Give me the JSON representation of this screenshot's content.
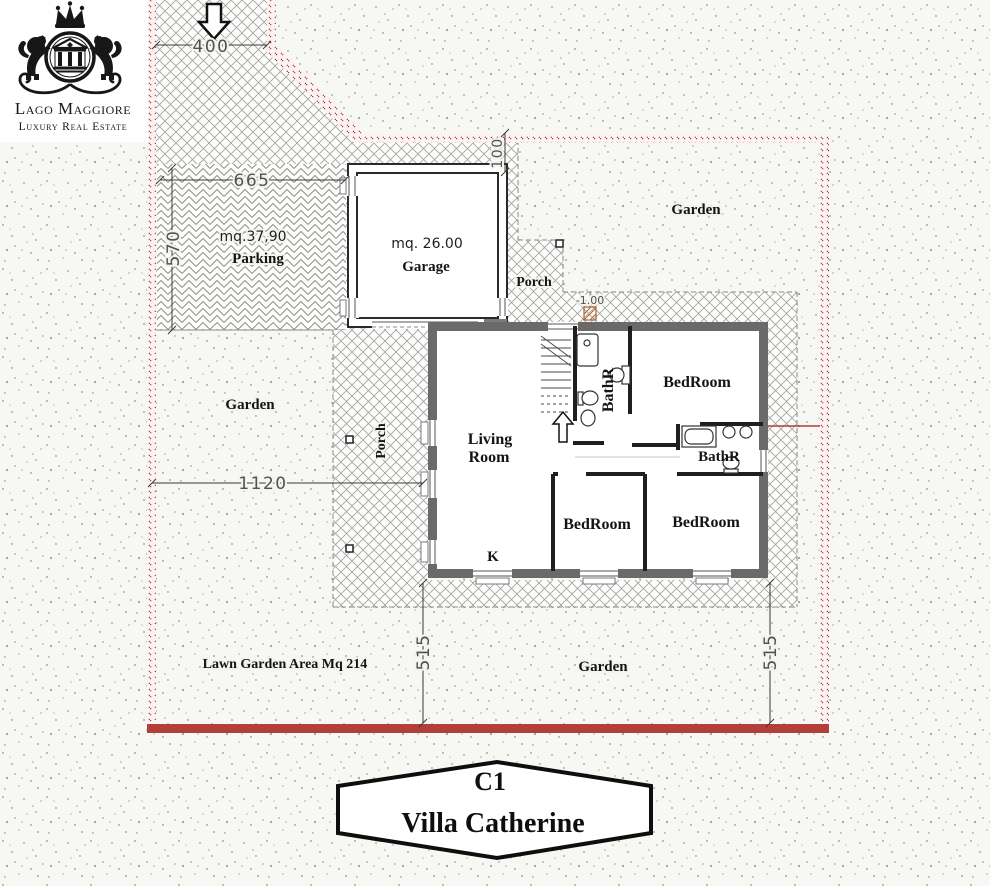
{
  "meta": {
    "title": "Villa Catherine floor plan"
  },
  "colors": {
    "boundary_red": "#b23f3a",
    "wall_gray": "#6a6a6a",
    "hatch_gray": "#9a9a9a",
    "paper": "#f6f6f2",
    "step_marker_orange": "#b06030"
  },
  "logo": {
    "line1": "Lago Maggiore",
    "line2": "Luxury Real Estate"
  },
  "icons": {
    "entrance": "arrow-down-icon",
    "stairs": "arrow-up-icon",
    "crown": "crown-icon",
    "left_lion": "lion-icon",
    "right_lion": "lion-icon",
    "emblem": "temple-icon"
  },
  "dimensions": {
    "entrance_width": "400",
    "parking_width": "665",
    "parking_depth": "570",
    "garage_offset": "100",
    "garden_width": "1120",
    "garden_depth_left": "515",
    "garden_depth_right": "515",
    "entry_level": "-1.00"
  },
  "zones": {
    "parking": {
      "area": "mq.37,90",
      "label": "Parking"
    },
    "garage": {
      "area": "mq. 26.00",
      "label": "Garage"
    },
    "porch_top": {
      "label": "Porch"
    },
    "porch_left": {
      "label": "Porch"
    },
    "garden_top": {
      "label": "Garden"
    },
    "garden_left": {
      "label": "Garden"
    },
    "garden_bottom": {
      "label": "Garden"
    },
    "lawn": {
      "label": "Lawn Garden Area Mq 214"
    }
  },
  "rooms": {
    "living": {
      "line1": "Living",
      "line2": "Room"
    },
    "kitchen": {
      "label": "K"
    },
    "bath_main": {
      "label": "BathR"
    },
    "bath_second": {
      "label": "BathR"
    },
    "bedroom_master": {
      "label": "BedRoom"
    },
    "bedroom_middle": {
      "label": "BedRoom"
    },
    "bedroom_right": {
      "label": "BedRoom"
    }
  },
  "badge": {
    "code": "C1",
    "name": "Villa Catherine"
  }
}
